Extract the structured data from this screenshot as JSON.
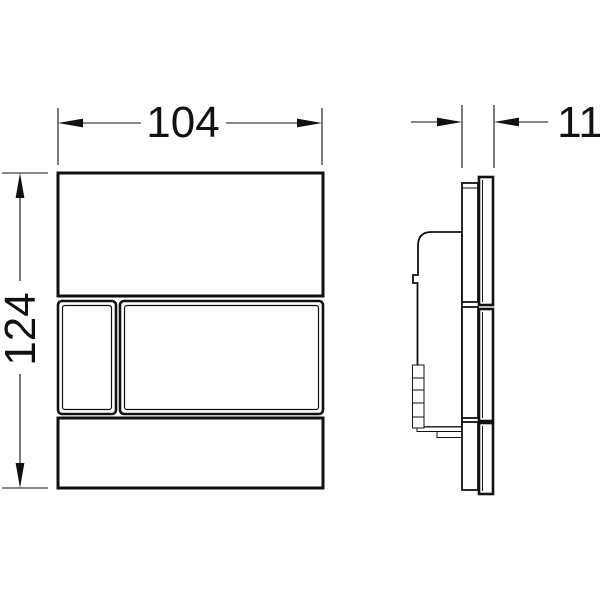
{
  "drawing": {
    "type": "technical-dimension-drawing",
    "views": {
      "front_view": "flush-plate-front",
      "side_view": "flush-plate-profile"
    },
    "dimensions": {
      "width": "104",
      "height": "124",
      "depth": "11"
    },
    "colors": {
      "line": "#111111",
      "background": "#ffffff"
    }
  }
}
